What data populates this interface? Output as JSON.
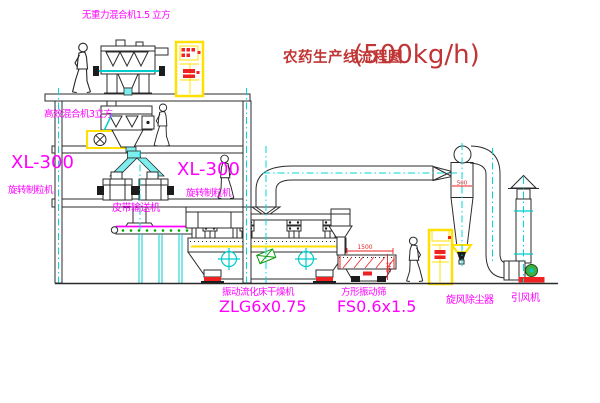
{
  "title": {
    "text": "农药生产线流程图",
    "capacity": "(500kg/h)"
  },
  "labels": {
    "gravity_mixer": "无重力混合机1.5 立方",
    "high_efficiency_mixer": "高效混合机3立方",
    "granulator_left_model": "XL-300",
    "granulator_left_name": "旋转制粒机",
    "granulator_mid_model": "XL-300",
    "granulator_mid_name": "旋转制粒机",
    "belt_conveyor": "皮带输送机",
    "dryer_name": "振动流化床干燥机",
    "dryer_model": "ZLG6x0.75",
    "sieve_name": "方形振动筛",
    "sieve_model": "FS0.6x1.5",
    "cyclone": "旋风除尘器",
    "fan": "引风机"
  },
  "dimensions": {
    "sieve_length": "1500",
    "sieve_height": "541",
    "cyclone_diameter": "500"
  },
  "colors": {
    "label_magenta": "#ff00ff",
    "title_red": "#c03535",
    "centerline_cyan": "#00d8d8",
    "cabinet_yellow": "#ffe000",
    "accent_red": "#ee2222",
    "motor_green": "#3faf3f",
    "chute_cyan": "#7deeee"
  }
}
